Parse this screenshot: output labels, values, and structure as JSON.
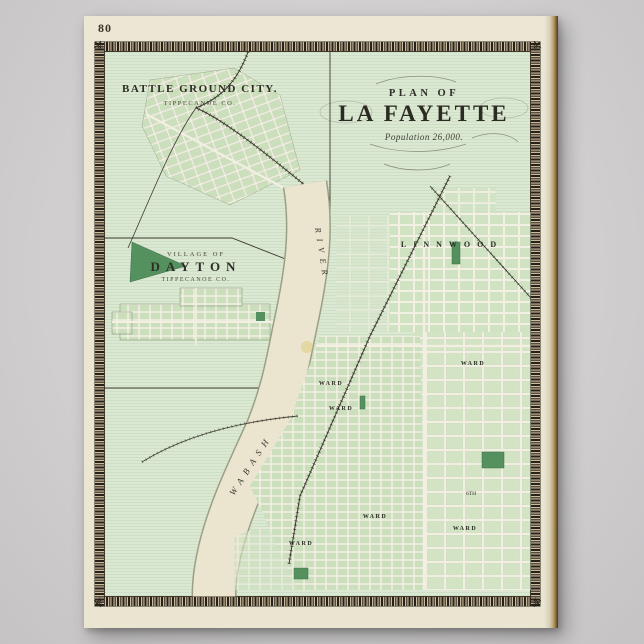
{
  "page": {
    "number": "80"
  },
  "main_map": {
    "kicker": "PLAN OF",
    "title": "LA FAYETTE",
    "subtitle": "Population 26,000.",
    "district_label": "LINNWOOD",
    "ward_label": "WARD",
    "street_label": "6TH",
    "river_name_upper": "RIVER",
    "river_name_lower": "WABASH"
  },
  "insets": {
    "battle_ground": {
      "title": "BATTLE GROUND CITY.",
      "subtitle": "TIPPECANOE CO."
    },
    "dayton": {
      "kicker": "VILLAGE OF",
      "title": "DAYTON",
      "subtitle": "TIPPECANOE CO."
    }
  },
  "ornaments": {
    "corner_glyph": "⚜"
  },
  "colors": {
    "poster_background": "#d0cecf",
    "page_cream": "#ebe6d3",
    "map_green": "#dbe8d2",
    "block_green": "#cfe2c1",
    "park_green": "#55915f",
    "river_tan": "#ebe4cf",
    "frame_sepia": "#3a3128",
    "binding_brown": "#7c6237"
  }
}
